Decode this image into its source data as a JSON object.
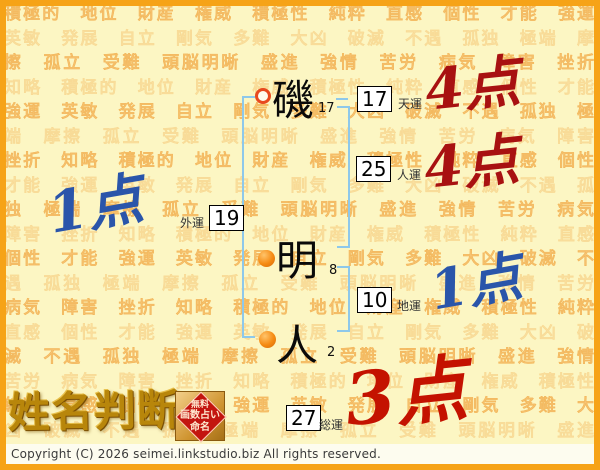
{
  "background_words": "積極的　地位　財産　権威　積極性　純粋　直感　個性　才能　強運　英敏　発展　自立　剛気　多難　大凶　破滅　不遇　孤独　極端　摩擦　孤立　受難　頭脳明晰　盛進　強情　苦労　病気　障害　挫折　知略　",
  "name": {
    "chars": [
      {
        "char": "磯",
        "strokes": "17",
        "marker": "ring"
      },
      {
        "char": "明",
        "strokes": "8",
        "marker": "dot"
      },
      {
        "char": "人",
        "strokes": "2",
        "marker": "dot"
      }
    ]
  },
  "fortunes": [
    {
      "label": "天運",
      "value": "17",
      "score": "4点"
    },
    {
      "label": "人運",
      "value": "25",
      "score": "4点"
    },
    {
      "label": "外運",
      "value": "19",
      "score": "1点"
    },
    {
      "label": "地運",
      "value": "10",
      "score": "1点"
    },
    {
      "label": "総運",
      "value": "27",
      "score": "3点"
    }
  ],
  "logo": {
    "title": "姓名判断",
    "stamp_lines": [
      "無料",
      "画数占い",
      "命名"
    ]
  },
  "footer": {
    "copyright": "Copyright (C) 2026 seimei.linkstudio.biz All rights reserved."
  },
  "colors": {
    "frame_orange": "#f6a317",
    "page_bg": "#fcf6c3",
    "bg_word": "#f8c87c",
    "bracket_blue": "#8ec8ea",
    "score_red_dark": "#a81111",
    "score_red_bright": "#c41200",
    "score_blue": "#2a55aa",
    "gold": "#b8860b"
  }
}
